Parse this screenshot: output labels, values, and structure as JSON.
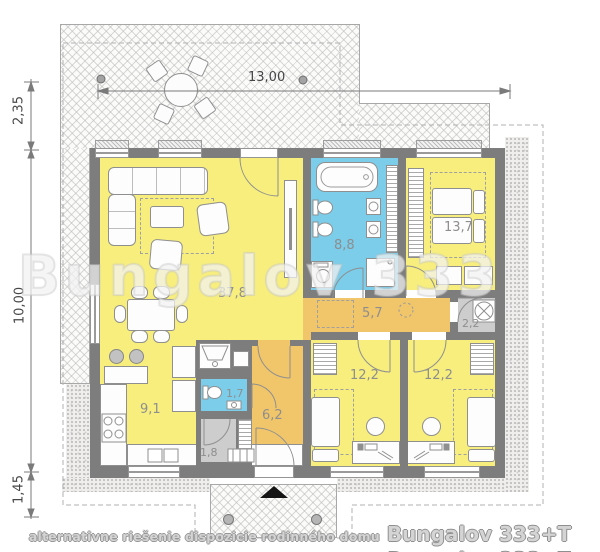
{
  "watermark": "Bungalov 333",
  "caption": {
    "prefix": "alternativne riešenie dispozicie rodinného domu",
    "title": "Bungalov 333+T"
  },
  "dimensions": {
    "top_width": "13,00",
    "left_upper": "2,35",
    "left_middle": "10,00",
    "left_lower": "1,45"
  },
  "rooms": {
    "living": {
      "label": "37,8"
    },
    "kitchen": {
      "label": "9,1"
    },
    "bathroom": {
      "label": "8,8"
    },
    "bedroom_main": {
      "label": "13,7"
    },
    "hall": {
      "label": "5,7"
    },
    "utility": {
      "label": "2,2"
    },
    "bedroom_left": {
      "label": "12,2"
    },
    "bedroom_right": {
      "label": "12,2"
    },
    "wc": {
      "label": "1,7"
    },
    "corridor": {
      "label": "6,2"
    },
    "storage": {
      "label": "1,8"
    }
  },
  "colors": {
    "room_yellow": "#f7ee7e",
    "room_blue": "#7bcdea",
    "room_amber": "#f1c66b",
    "room_gray": "#cdcdcd",
    "wall_gray": "#7d7d7d",
    "entrance_arrow": "#151515"
  }
}
